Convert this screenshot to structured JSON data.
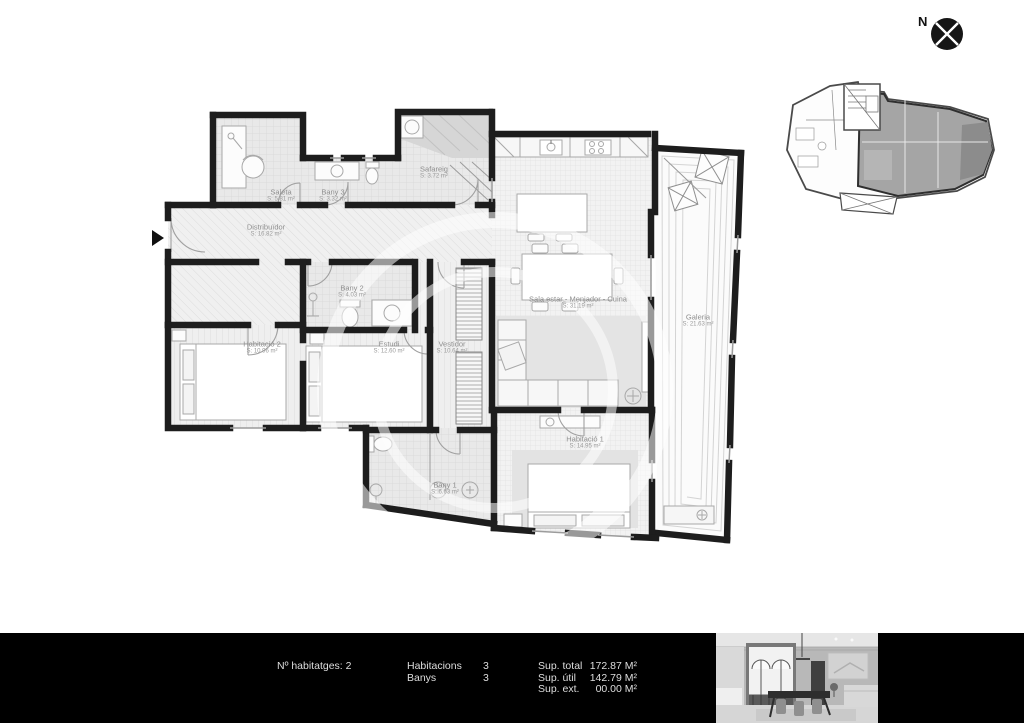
{
  "compass": {
    "north_label": "N"
  },
  "plan": {
    "rooms": [
      {
        "id": "saleta",
        "name": "Saleta",
        "area": "S: 5.81 m²"
      },
      {
        "id": "bany3",
        "name": "Bany 3",
        "area": "S: 3.32 m²"
      },
      {
        "id": "safareig",
        "name": "Safareig",
        "area": "S: 3.72 m²"
      },
      {
        "id": "distribuidor",
        "name": "Distribuïdor",
        "area": "S: 16.82 m²"
      },
      {
        "id": "bany2",
        "name": "Bany 2",
        "area": "S: 4.03 m²"
      },
      {
        "id": "habitacio2",
        "name": "Habitació 2",
        "area": "S: 10.96 m²"
      },
      {
        "id": "estudi",
        "name": "Estudi",
        "area": "S: 12.60 m²"
      },
      {
        "id": "vestidor",
        "name": "Vestidor",
        "area": "S: 10.64 m²"
      },
      {
        "id": "bany1",
        "name": "Bany 1",
        "area": "S: 6.63 m²"
      },
      {
        "id": "sala",
        "name": "Sala estar - Menjador - Cuina",
        "area": "S: 31.19 m²"
      },
      {
        "id": "galeria",
        "name": "Galeria",
        "area": "S: 21.63 m²"
      },
      {
        "id": "habitacio1",
        "name": "Habitació 1",
        "area": "S: 14.95 m²"
      }
    ]
  },
  "footer": {
    "units_label": "Nº habitatges: 2",
    "stats": [
      {
        "label": "Habitacions",
        "value": "3"
      },
      {
        "label": "Banys",
        "value": "3"
      }
    ],
    "areas": [
      {
        "label": "Sup. total",
        "value": "172.87 M²"
      },
      {
        "label": "Sup. útil",
        "value": "142.79 M²"
      },
      {
        "label": "Sup. ext.",
        "value": "00.00 M²"
      }
    ]
  },
  "colors": {
    "wall": "#1d1d1d",
    "footer_bg": "#000000",
    "label_text": "#8f8f8f",
    "minimap_unit_fill": "#a5a5a5"
  }
}
